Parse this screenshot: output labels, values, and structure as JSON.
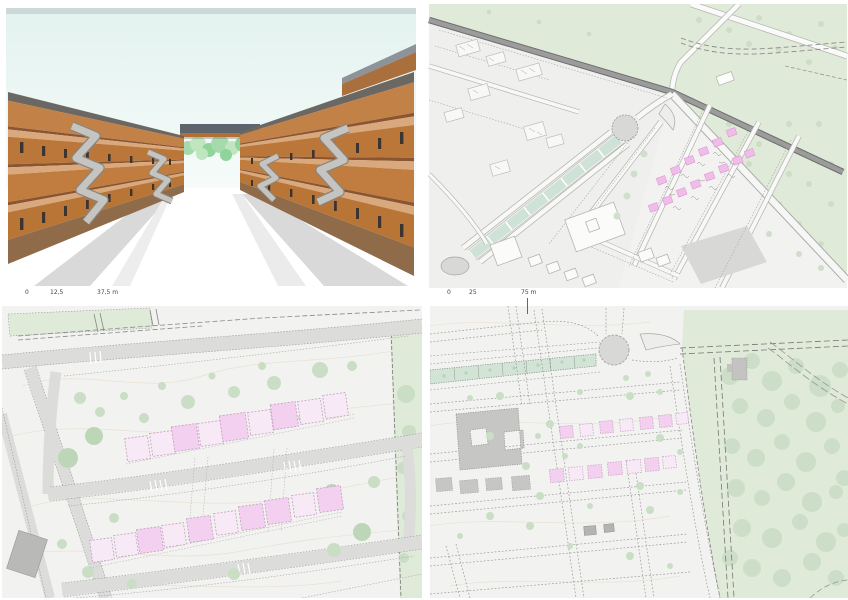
{
  "scalebars": {
    "perspective": {
      "ticks": [
        "0",
        "12,5",
        "37,5 m"
      ]
    },
    "axonometric": {
      "ticks": [
        "0",
        "25",
        "75 m"
      ]
    }
  },
  "colors": {
    "sky_top": "#dcebe9",
    "terracotta": "#c17a40",
    "terracotta_dark": "#8f5a2e",
    "slab": "#d9a87c",
    "roof_gray": "#6b6763",
    "concrete": "#bdbbb7",
    "tree_bright": "#a5dbac",
    "street_shadow": "#d9d9d9",
    "plan_bg": "#f2f2f0",
    "plan_green": "#e0ead9",
    "plan_tree": "#c9dec5",
    "teal_strip": "#d2e4d6",
    "road_fill": "#dcdcda",
    "road_dark": "#8f8f8f",
    "pink_light": "#f8e9f6",
    "pink_dark": "#f3d0ef",
    "pink_roof": "#f0bce9",
    "building_gray": "#c6c6c4",
    "outline_gray": "#9a9a9a",
    "contour": "#eadfd0",
    "label": "#444444"
  }
}
